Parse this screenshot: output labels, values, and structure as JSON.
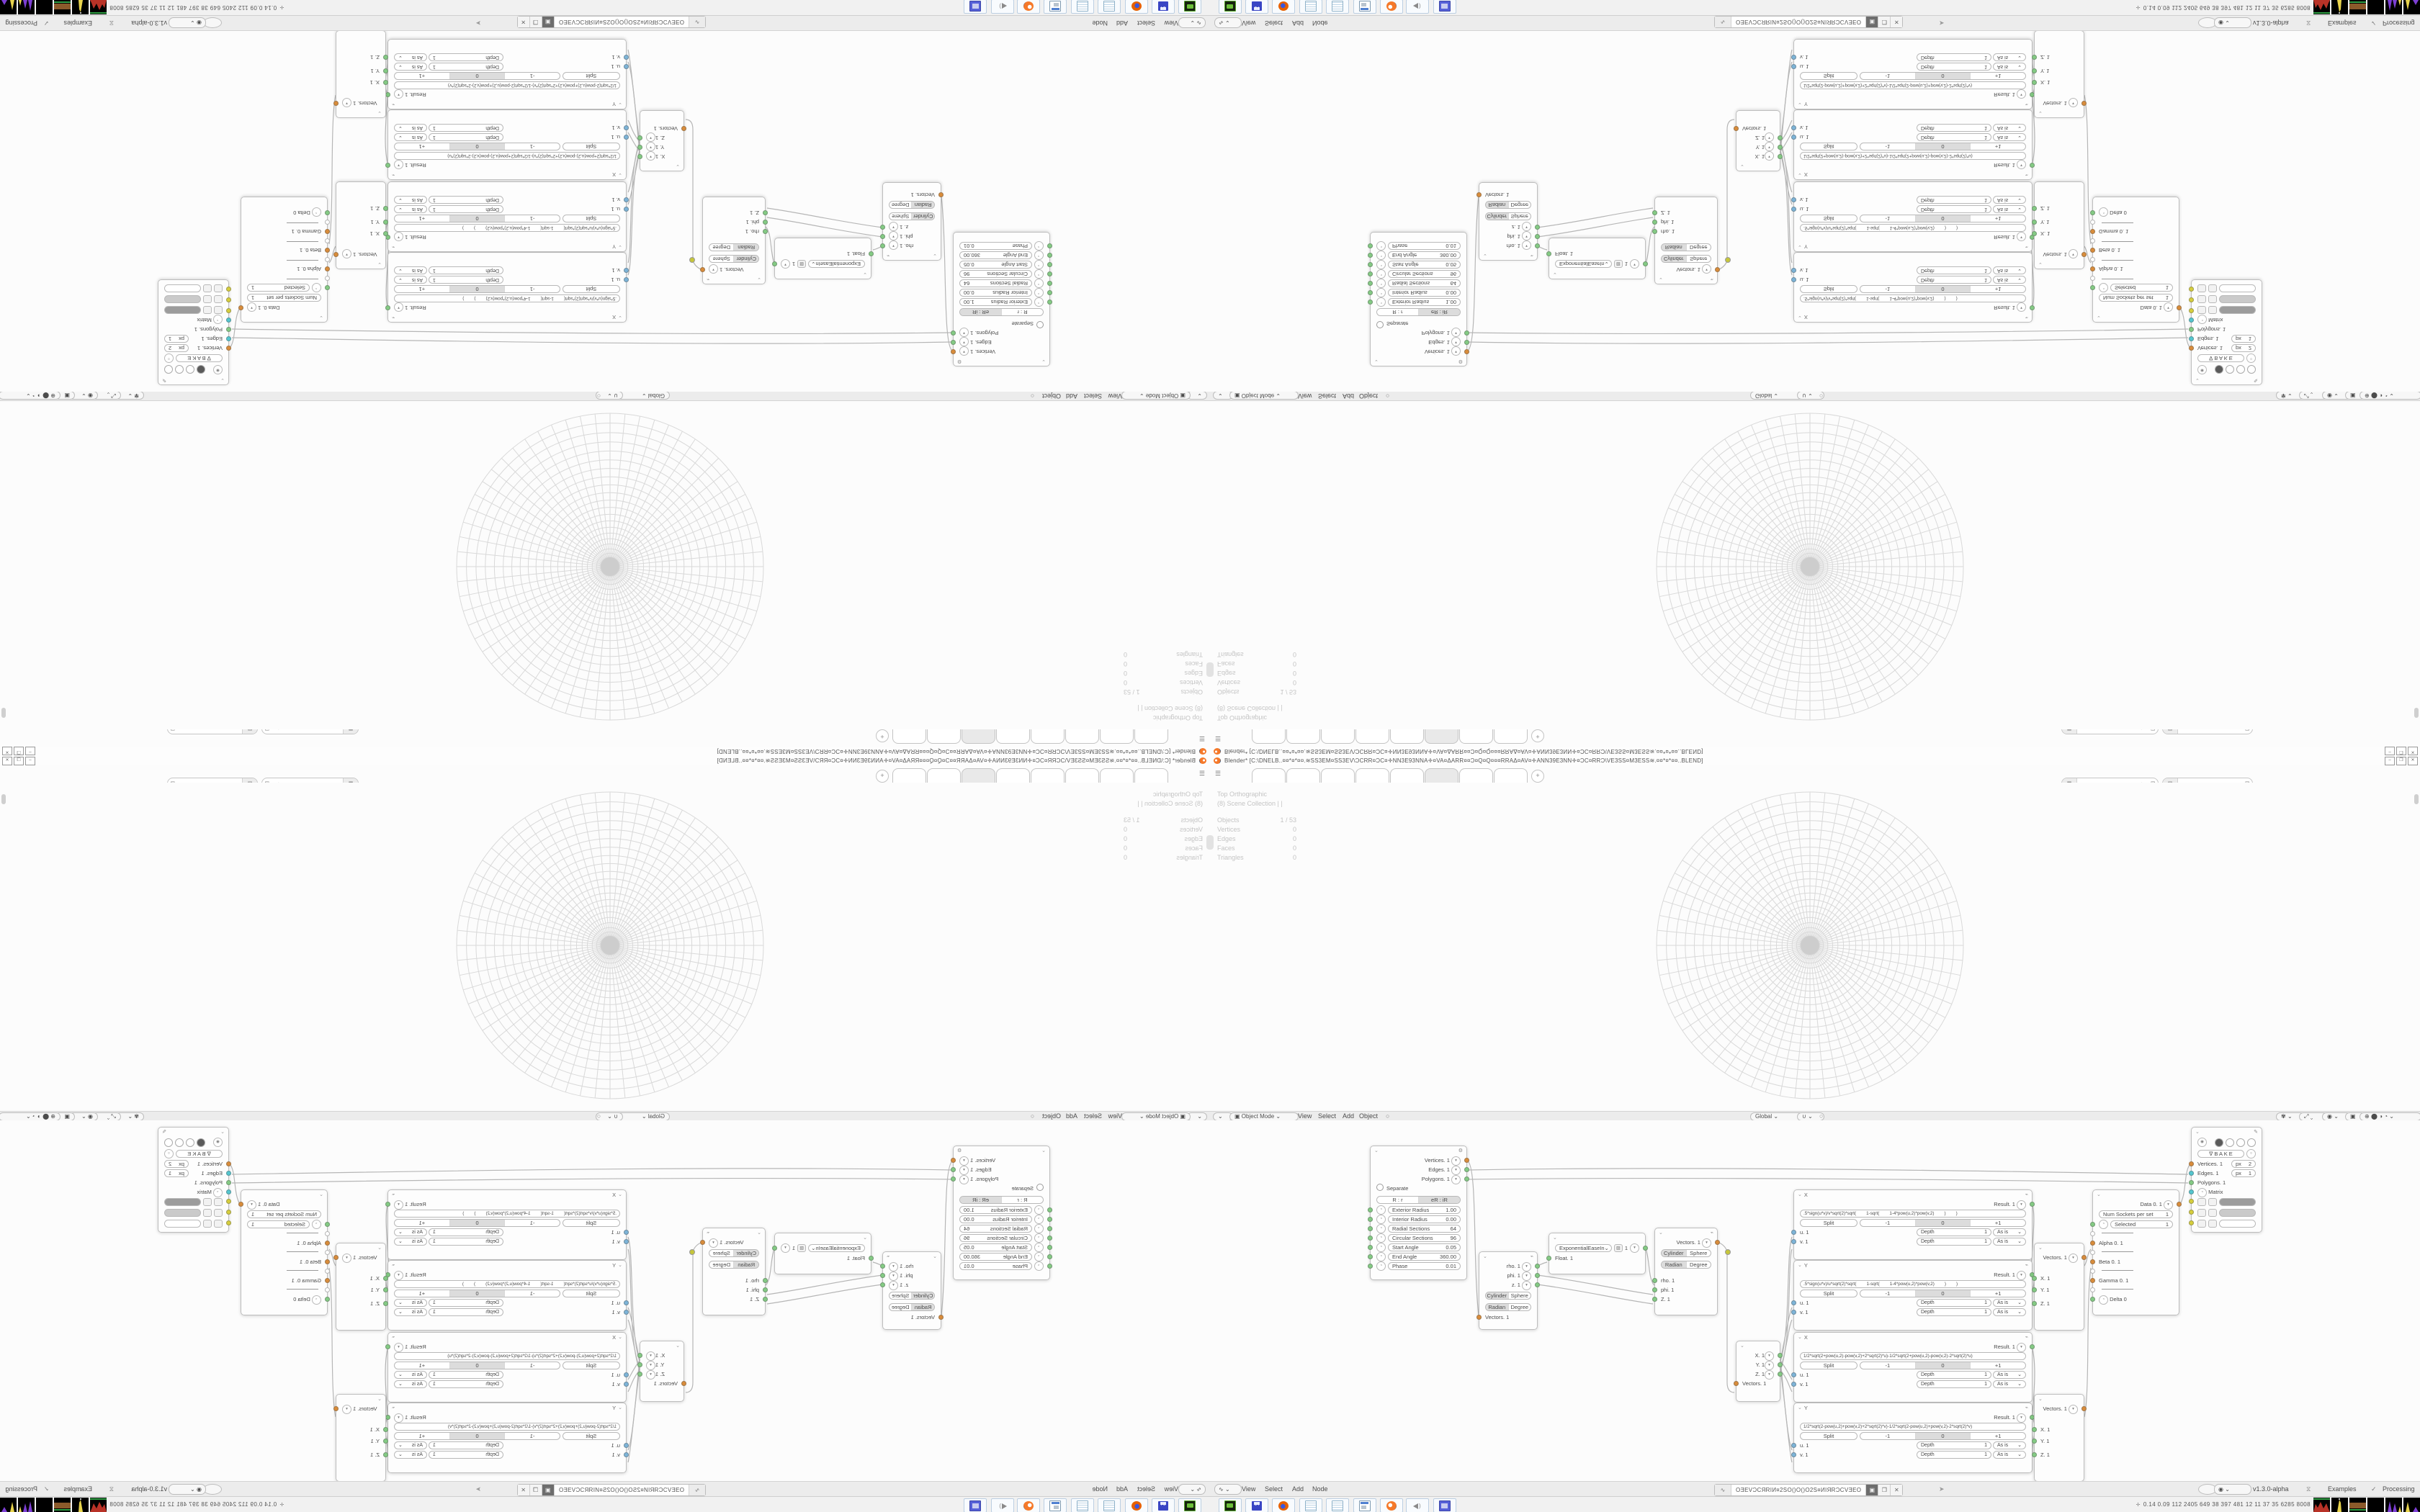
{
  "window": {
    "title": "Blender* [C:\\DNELB..¤¤*¤*¤¤.≋SS3EM¤SS3EV\\ƆCRR¤ƆC¤✛NN3E93NNA✛¤VA¤ΔARR¤¤Ɔ¤Q¤Q¤¤¤RRAΔ¤AV¤✛ANN39E3NN✛¤ƆC¤RRƆ\\VE3SS¤M3ESS≋.¤¤*¤*¤¤..BLEND]",
    "minimize": "‒",
    "maximize": "❐",
    "close": "✕"
  },
  "topbar": {
    "tab_count": 8,
    "active_tab_index": 6,
    "new_tab": "+"
  },
  "viewport": {
    "overlay": {
      "view": "Top Orthographic",
      "collection": "(8) Scene Collection | |",
      "stats": [
        {
          "label": "Objects",
          "value": "1 / 53"
        },
        {
          "label": "Vertices",
          "value": "0"
        },
        {
          "label": "Edges",
          "value": "0"
        },
        {
          "label": "Faces",
          "value": "0"
        },
        {
          "label": "Triangles",
          "value": "0"
        }
      ]
    },
    "header": {
      "mode": "Object Mode",
      "menus": [
        "View",
        "Select",
        "Add",
        "Object"
      ],
      "orientation": "Global"
    }
  },
  "node_editor": {
    "header": {
      "menus": [
        "View",
        "Select",
        "Add",
        "Node"
      ],
      "tree_name": "OƎEVƆCЯRIИ¤2SO()O()O2S¤ИIЯRƆCVƎEO",
      "version": "v1.3.0-alpha",
      "examples": "Examples",
      "processing": "Processing"
    },
    "nodes": {
      "cylinder": {
        "outputs": [
          "Vertices. 1",
          "Edges. 1",
          "Polygons. 1"
        ],
        "separate": "Separate",
        "radius_seg": [
          "R : r",
          "eR : iR"
        ],
        "params": [
          {
            "label": "Exterior Radius",
            "value": "1.00"
          },
          {
            "label": "Interior Radius",
            "value": "0.00"
          },
          {
            "label": "Radial Sections",
            "value": "64"
          },
          {
            "label": "Circular Sections",
            "value": "96"
          },
          {
            "label": "Start Angle",
            "value": "0.05"
          },
          {
            "label": "End Angle",
            "value": "360.00"
          },
          {
            "label": "Phase",
            "value": "0.01"
          }
        ]
      },
      "polar_out": {
        "outputs": [
          "rho. 1",
          "phi. 1",
          "z. 1"
        ],
        "seg1": [
          "Cylinder",
          "Sphere"
        ],
        "seg2": [
          "Radian",
          "Degree"
        ],
        "input": "Vectors. 1"
      },
      "easing": {
        "mode": "ExponentialEaseIn",
        "value": "1",
        "input": "Float. 1"
      },
      "polar_in": {
        "output": "Vectors. 1",
        "seg1": [
          "Cylinder",
          "Sphere"
        ],
        "seg2": [
          "Radian",
          "Degree"
        ],
        "inputs": [
          "rho. 1",
          "phi. 1",
          "Z. 1"
        ]
      },
      "vector_out": {
        "outputs": [
          "X. 1",
          "Y. 1",
          "Z. 1"
        ],
        "input": "Vectors. 1"
      },
      "f1": {
        "name": "X",
        "result": "Result. 1",
        "segs": [
          ".5*sign(u*v)/v*sqrt(2)*sqrt(",
          "1-sqrt(",
          "1-4*pow(u,2)*pow(v,2)",
          ")",
          ")"
        ]
      },
      "f2": {
        "name": "Y",
        "result": "Result. 1",
        "segs": [
          ".5*sign(u*v)/u*sqrt(2)*sqrt(",
          "1-sqrt(",
          "1-4*pow(u,2)*pow(v,2)",
          ")",
          ")"
        ]
      },
      "f3": {
        "name": "X",
        "result": "Result. 1",
        "formula": "1/2*sqrt(2+pow(u,2)-pow(v,2)+2*sqrt(2)*u)-1/2*sqrt(2+pow(u,2)-pow(v,2)-2*sqrt(2)*u)"
      },
      "f4": {
        "name": "Y",
        "result": "Result. 1",
        "formula": "1/2*sqrt(2-pow(u,2)+pow(v,2)+2*sqrt(2)*v)-1/2*sqrt(2-pow(u,2)+pow(v,2)-2*sqrt(2)*v)"
      },
      "formula_common": {
        "split": "Split",
        "minus": "-1",
        "zero": "0",
        "plus": "+1",
        "depth_label": "Depth",
        "depth_value": "1",
        "mode": "As is",
        "u": "u. 1",
        "v": "v. 1"
      },
      "vector_in": {
        "output": "Vectors. 1",
        "inputs": [
          "X. 1",
          "Y. 1",
          "Z. 1"
        ]
      },
      "input_switch": {
        "output": "Data 0. 1",
        "num_label": "Num Sockets per set",
        "num_value": "1",
        "selected_label": "Selected",
        "selected_value": "1",
        "alpha": "Alpha 0. 1",
        "beta": "Beta 0. 1",
        "gamma": "Gamma 0. 1",
        "delta": "Delta 0"
      },
      "viewer": {
        "bake": "B A K E",
        "vertices": "Vertices. 1",
        "vertices_px_label": "px",
        "vertices_px": "2",
        "edges": "Edges. 1",
        "edges_px_label": "px",
        "edges_px": "1",
        "polygons": "Polygons. 1",
        "matrix": "Matrix",
        "swatch_colors": [
          "#9c9c9c",
          "#cacaca",
          "#ffffff"
        ]
      }
    }
  },
  "taskbar": {
    "stats": "0.14 0.09  112 2405 649  38  397  481  12  11  37  35  6285 8008",
    "icons": [
      "console",
      "floppy-64",
      "firefox",
      "notepad",
      "notepad",
      "image-viewer",
      "blender",
      "volume",
      "media-player"
    ],
    "floppy_label": "64"
  },
  "icons": {
    "chevron_down": "⌄",
    "dropdown": "▾",
    "hamburger": "☰",
    "gear": "⚙",
    "pencil": "✎",
    "wrench": "⌁",
    "close": "✕",
    "copy": "❐",
    "pin": "➤",
    "check": "✓",
    "dna": "⧖",
    "shield": "▣",
    "circle": "○",
    "dot": "⬤",
    "half": "◑",
    "quarter": "◔",
    "target": "◉",
    "plus_gizmo": "⊕",
    "hand": "✾",
    "move": "⤢",
    "magnet": "∪",
    "tree": "∿",
    "bake_tri": "∇",
    "obj": "▣",
    "person": "✛",
    "curve": "▨",
    "sphere_icon": "◍",
    "layer": "▤",
    "scene": "▦"
  },
  "colors": {
    "socket_orange": "#d98c3a",
    "socket_green": "#84cb84",
    "socket_cyan": "#54c6cf",
    "socket_blue": "#7db4d8",
    "socket_yellow": "#d6ce3c",
    "wire": "#b6b6b6",
    "grid_line": "#d9d9d9",
    "header_bg": "#ececec",
    "area_bg": "#fcfcfc"
  }
}
